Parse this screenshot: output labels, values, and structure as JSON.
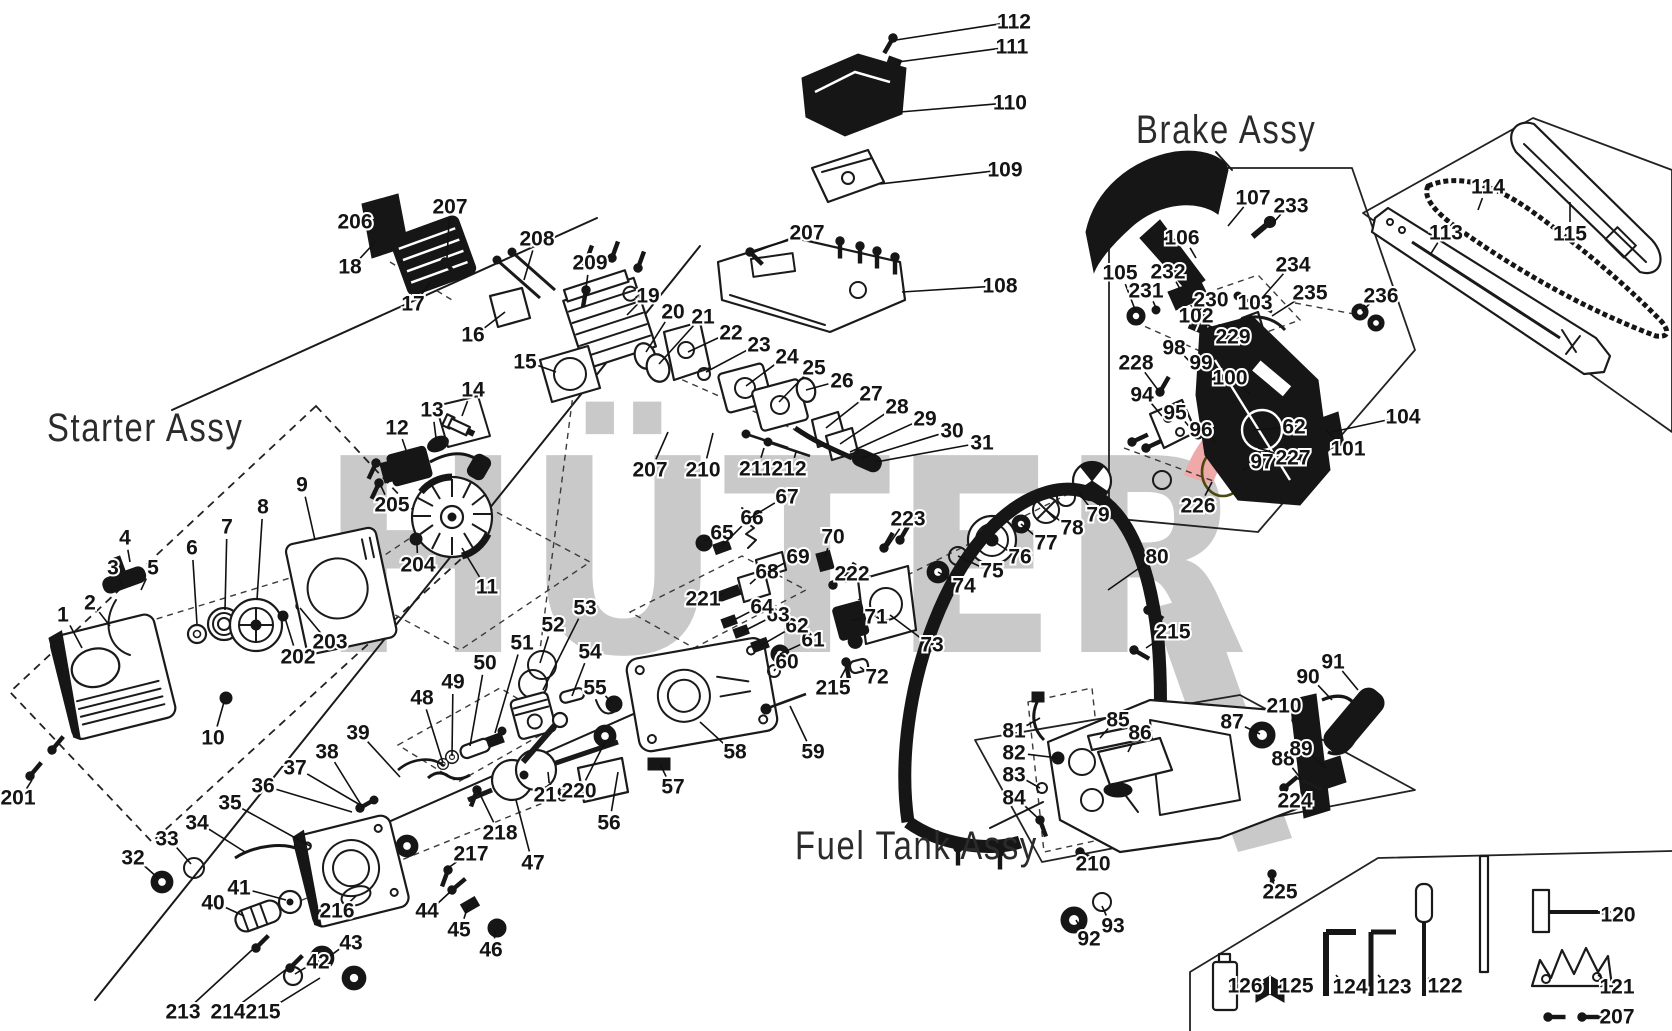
{
  "watermark": {
    "text": "HÜTER",
    "gray": "#c9c9c9",
    "pink": "#efa9a9",
    "dark_red": "#7d1416",
    "yellow": "#f7f3a6"
  },
  "assemblies": [
    {
      "label": "Starter Assy",
      "x": 47,
      "y": 406
    },
    {
      "label": "Brake Assy",
      "x": 1136,
      "y": 108
    },
    {
      "label": "Fuel Tank Assy",
      "x": 795,
      "y": 824
    }
  ],
  "parts": [
    {
      "n": "1",
      "x": 63,
      "y": 615,
      "t": [
        82,
        648
      ]
    },
    {
      "n": "2",
      "x": 90,
      "y": 603,
      "t": [
        110,
        626
      ]
    },
    {
      "n": "3",
      "x": 113,
      "y": 568,
      "t": [
        122,
        586
      ]
    },
    {
      "n": "4",
      "x": 125,
      "y": 538,
      "t": [
        130,
        562
      ]
    },
    {
      "n": "5",
      "x": 153,
      "y": 568,
      "t": [
        141,
        590
      ]
    },
    {
      "n": "6",
      "x": 192,
      "y": 548,
      "t": [
        197,
        624
      ]
    },
    {
      "n": "7",
      "x": 227,
      "y": 527,
      "t": [
        225,
        610
      ]
    },
    {
      "n": "8",
      "x": 263,
      "y": 507,
      "t": [
        257,
        600
      ]
    },
    {
      "n": "9",
      "x": 302,
      "y": 485,
      "t": [
        315,
        540
      ]
    },
    {
      "n": "10",
      "x": 213,
      "y": 738,
      "t": [
        224,
        702
      ]
    },
    {
      "n": "11",
      "x": 487,
      "y": 587,
      "t": [
        462,
        548
      ]
    },
    {
      "n": "12",
      "x": 397,
      "y": 428,
      "t": [
        406,
        450
      ]
    },
    {
      "n": "13",
      "x": 432,
      "y": 410,
      "t": [
        436,
        438
      ]
    },
    {
      "n": "14",
      "x": 473,
      "y": 390,
      "t": [
        462,
        416
      ]
    },
    {
      "n": "15",
      "x": 525,
      "y": 362,
      "t": [
        556,
        372
      ]
    },
    {
      "n": "16",
      "x": 473,
      "y": 335,
      "t": [
        505,
        312
      ]
    },
    {
      "n": "17",
      "x": 413,
      "y": 304,
      "t": [
        430,
        282
      ]
    },
    {
      "n": "18",
      "x": 350,
      "y": 267,
      "t": [
        377,
        240
      ]
    },
    {
      "n": "19",
      "x": 648,
      "y": 296,
      "t": [
        627,
        315
      ]
    },
    {
      "n": "20",
      "x": 673,
      "y": 312,
      "t": [
        646,
        352
      ]
    },
    {
      "n": "21",
      "x": 703,
      "y": 317,
      "t": [
        659,
        364
      ]
    },
    {
      "n": "22",
      "x": 731,
      "y": 333,
      "t": [
        688,
        352
      ]
    },
    {
      "n": "23",
      "x": 759,
      "y": 345,
      "t": [
        706,
        372
      ]
    },
    {
      "n": "24",
      "x": 787,
      "y": 357,
      "t": [
        746,
        386
      ]
    },
    {
      "n": "25",
      "x": 814,
      "y": 368,
      "t": [
        779,
        402
      ]
    },
    {
      "n": "26",
      "x": 842,
      "y": 381,
      "t": [
        806,
        390
      ]
    },
    {
      "n": "27",
      "x": 871,
      "y": 394,
      "t": [
        826,
        428
      ]
    },
    {
      "n": "28",
      "x": 897,
      "y": 407,
      "t": [
        840,
        444
      ]
    },
    {
      "n": "29",
      "x": 925,
      "y": 419,
      "t": [
        850,
        452
      ]
    },
    {
      "n": "30",
      "x": 952,
      "y": 431,
      "t": [
        862,
        458
      ]
    },
    {
      "n": "31",
      "x": 982,
      "y": 443,
      "t": [
        876,
        462
      ]
    },
    {
      "n": "32",
      "x": 133,
      "y": 858,
      "t": [
        158,
        878
      ]
    },
    {
      "n": "33",
      "x": 167,
      "y": 839,
      "t": [
        191,
        864
      ]
    },
    {
      "n": "34",
      "x": 197,
      "y": 823,
      "t": [
        245,
        852
      ]
    },
    {
      "n": "35",
      "x": 230,
      "y": 803,
      "t": [
        310,
        846
      ]
    },
    {
      "n": "36",
      "x": 263,
      "y": 786,
      "t": [
        352,
        812
      ]
    },
    {
      "n": "37",
      "x": 295,
      "y": 768,
      "t": [
        362,
        806
      ]
    },
    {
      "n": "38",
      "x": 327,
      "y": 752,
      "t": [
        363,
        808
      ]
    },
    {
      "n": "39",
      "x": 358,
      "y": 733,
      "t": [
        400,
        777
      ]
    },
    {
      "n": "40",
      "x": 213,
      "y": 903,
      "t": [
        244,
        916
      ]
    },
    {
      "n": "41",
      "x": 239,
      "y": 888,
      "t": [
        286,
        900
      ]
    },
    {
      "n": "42",
      "x": 318,
      "y": 962,
      "t": [
        295,
        974
      ]
    },
    {
      "n": "43",
      "x": 351,
      "y": 943,
      "t": [
        330,
        956
      ]
    },
    {
      "n": "44",
      "x": 427,
      "y": 911,
      "t": [
        450,
        892
      ]
    },
    {
      "n": "45",
      "x": 459,
      "y": 930,
      "t": [
        468,
        906
      ]
    },
    {
      "n": "46",
      "x": 491,
      "y": 950,
      "t": [
        496,
        930
      ]
    },
    {
      "n": "47",
      "x": 533,
      "y": 863,
      "t": [
        516,
        800
      ]
    },
    {
      "n": "48",
      "x": 422,
      "y": 698,
      "t": [
        443,
        763
      ]
    },
    {
      "n": "49",
      "x": 453,
      "y": 682,
      "t": [
        452,
        756
      ]
    },
    {
      "n": "50",
      "x": 485,
      "y": 663,
      "t": [
        470,
        746
      ]
    },
    {
      "n": "51",
      "x": 522,
      "y": 643,
      "t": [
        495,
        733
      ]
    },
    {
      "n": "52",
      "x": 553,
      "y": 625,
      "t": [
        540,
        663
      ]
    },
    {
      "n": "53",
      "x": 585,
      "y": 608,
      "t": [
        543,
        690
      ]
    },
    {
      "n": "54",
      "x": 590,
      "y": 652,
      "t": [
        572,
        696
      ]
    },
    {
      "n": "55",
      "x": 595,
      "y": 688,
      "t": [
        612,
        703
      ]
    },
    {
      "n": "56",
      "x": 609,
      "y": 823,
      "t": [
        618,
        772
      ]
    },
    {
      "n": "57",
      "x": 673,
      "y": 787,
      "t": [
        660,
        764
      ]
    },
    {
      "n": "58",
      "x": 735,
      "y": 752,
      "t": [
        700,
        722
      ]
    },
    {
      "n": "59",
      "x": 813,
      "y": 752,
      "t": [
        790,
        706
      ]
    },
    {
      "n": "60",
      "x": 787,
      "y": 662,
      "t": [
        774,
        671
      ]
    },
    {
      "n": "61",
      "x": 813,
      "y": 640,
      "t": [
        780,
        654
      ]
    },
    {
      "n": "62",
      "x": 797,
      "y": 626,
      "t": [
        760,
        646
      ]
    },
    {
      "n": "62",
      "x": 1294,
      "y": 427,
      "t": [
        1253,
        430
      ]
    },
    {
      "n": "63",
      "x": 778,
      "y": 615,
      "t": [
        742,
        632
      ]
    },
    {
      "n": "64",
      "x": 762,
      "y": 607,
      "t": [
        730,
        622
      ]
    },
    {
      "n": "65",
      "x": 722,
      "y": 533,
      "t": [
        704,
        541
      ]
    },
    {
      "n": "66",
      "x": 752,
      "y": 518,
      "t": [
        722,
        546
      ]
    },
    {
      "n": "67",
      "x": 787,
      "y": 497,
      "t": [
        750,
        518
      ]
    },
    {
      "n": "68",
      "x": 767,
      "y": 572,
      "t": [
        750,
        584
      ]
    },
    {
      "n": "69",
      "x": 798,
      "y": 557,
      "t": [
        768,
        572
      ]
    },
    {
      "n": "70",
      "x": 833,
      "y": 537,
      "t": [
        825,
        557
      ]
    },
    {
      "n": "71",
      "x": 876,
      "y": 617,
      "t": [
        852,
        620
      ]
    },
    {
      "n": "72",
      "x": 877,
      "y": 677,
      "t": [
        860,
        667
      ]
    },
    {
      "n": "73",
      "x": 932,
      "y": 645,
      "t": [
        890,
        615
      ]
    },
    {
      "n": "74",
      "x": 964,
      "y": 586,
      "t": [
        938,
        572
      ]
    },
    {
      "n": "75",
      "x": 992,
      "y": 571,
      "t": [
        958,
        556
      ]
    },
    {
      "n": "76",
      "x": 1020,
      "y": 557,
      "t": [
        992,
        540
      ]
    },
    {
      "n": "77",
      "x": 1046,
      "y": 543,
      "t": [
        1021,
        524
      ]
    },
    {
      "n": "78",
      "x": 1072,
      "y": 528,
      "t": [
        1046,
        510
      ]
    },
    {
      "n": "79",
      "x": 1098,
      "y": 515,
      "t": [
        1078,
        492
      ]
    },
    {
      "n": "80",
      "x": 1157,
      "y": 557,
      "t": [
        1108,
        590
      ]
    },
    {
      "n": "81",
      "x": 1014,
      "y": 731,
      "t": [
        1040,
        718
      ]
    },
    {
      "n": "82",
      "x": 1014,
      "y": 753,
      "t": [
        1058,
        758
      ]
    },
    {
      "n": "83",
      "x": 1014,
      "y": 775,
      "t": [
        1040,
        788
      ]
    },
    {
      "n": "84",
      "x": 1014,
      "y": 798,
      "t": [
        1040,
        820
      ]
    },
    {
      "n": "85",
      "x": 1118,
      "y": 720,
      "t": [
        1100,
        738
      ]
    },
    {
      "n": "86",
      "x": 1140,
      "y": 733,
      "t": [
        1128,
        752
      ]
    },
    {
      "n": "87",
      "x": 1232,
      "y": 722,
      "t": [
        1260,
        734
      ]
    },
    {
      "n": "88",
      "x": 1283,
      "y": 759,
      "t": [
        1302,
        780
      ]
    },
    {
      "n": "89",
      "x": 1301,
      "y": 749,
      "t": [
        1326,
        768
      ]
    },
    {
      "n": "90",
      "x": 1308,
      "y": 677,
      "t": [
        1332,
        700
      ]
    },
    {
      "n": "91",
      "x": 1333,
      "y": 662,
      "t": [
        1358,
        690
      ]
    },
    {
      "n": "92",
      "x": 1089,
      "y": 939,
      "t": [
        1076,
        920
      ]
    },
    {
      "n": "93",
      "x": 1113,
      "y": 926,
      "t": [
        1102,
        906
      ]
    },
    {
      "n": "94",
      "x": 1142,
      "y": 395,
      "t": [
        1162,
        416
      ]
    },
    {
      "n": "95",
      "x": 1175,
      "y": 413,
      "t": [
        1192,
        430
      ]
    },
    {
      "n": "96",
      "x": 1201,
      "y": 430,
      "t": [
        1216,
        443
      ]
    },
    {
      "n": "97",
      "x": 1262,
      "y": 462,
      "t": [
        1242,
        470
      ]
    },
    {
      "n": "98",
      "x": 1174,
      "y": 348,
      "t": [
        1194,
        366
      ]
    },
    {
      "n": "99",
      "x": 1201,
      "y": 363,
      "t": [
        1217,
        378
      ]
    },
    {
      "n": "100",
      "x": 1230,
      "y": 378,
      "t": [
        1250,
        394
      ]
    },
    {
      "n": "101",
      "x": 1348,
      "y": 449,
      "t": [
        1326,
        430
      ]
    },
    {
      "n": "102",
      "x": 1196,
      "y": 316,
      "t": [
        1212,
        329
      ]
    },
    {
      "n": "103",
      "x": 1255,
      "y": 303,
      "t": [
        1250,
        318
      ]
    },
    {
      "n": "104",
      "x": 1403,
      "y": 417,
      "t": [
        1332,
        432
      ]
    },
    {
      "n": "105",
      "x": 1120,
      "y": 273,
      "t": [
        1136,
        312
      ]
    },
    {
      "n": "106",
      "x": 1182,
      "y": 238,
      "t": [
        1196,
        258
      ]
    },
    {
      "n": "107",
      "x": 1253,
      "y": 198,
      "t": [
        1228,
        226
      ]
    },
    {
      "n": "108",
      "x": 1000,
      "y": 286,
      "t": [
        902,
        292
      ]
    },
    {
      "n": "109",
      "x": 1005,
      "y": 170,
      "t": [
        880,
        184
      ]
    },
    {
      "n": "110",
      "x": 1010,
      "y": 103,
      "t": [
        900,
        112
      ]
    },
    {
      "n": "111",
      "x": 1012,
      "y": 47,
      "t": [
        898,
        62
      ]
    },
    {
      "n": "112",
      "x": 1014,
      "y": 22,
      "t": [
        896,
        40
      ]
    },
    {
      "n": "113",
      "x": 1446,
      "y": 233,
      "t": [
        1430,
        255
      ]
    },
    {
      "n": "114",
      "x": 1488,
      "y": 187,
      "t": [
        1478,
        210
      ]
    },
    {
      "n": "115",
      "x": 1570,
      "y": 234,
      "t": [
        1570,
        202
      ]
    },
    {
      "n": "120",
      "x": 1618,
      "y": 915,
      "t": [
        1598,
        913
      ]
    },
    {
      "n": "121",
      "x": 1617,
      "y": 987,
      "t": [
        1598,
        975
      ]
    },
    {
      "n": "122",
      "x": 1445,
      "y": 986,
      "t": [
        1428,
        978
      ]
    },
    {
      "n": "123",
      "x": 1394,
      "y": 987,
      "t": [
        1378,
        975
      ]
    },
    {
      "n": "124",
      "x": 1350,
      "y": 987,
      "t": [
        1336,
        975
      ]
    },
    {
      "n": "125",
      "x": 1296,
      "y": 986,
      "t": [
        1284,
        988
      ]
    },
    {
      "n": "126",
      "x": 1245,
      "y": 986,
      "t": [
        1230,
        986
      ]
    },
    {
      "n": "201",
      "x": 18,
      "y": 798,
      "t": [
        32,
        780
      ]
    },
    {
      "n": "202",
      "x": 298,
      "y": 657,
      "t": [
        285,
        618
      ]
    },
    {
      "n": "203",
      "x": 330,
      "y": 642,
      "t": [
        300,
        608
      ]
    },
    {
      "n": "204",
      "x": 418,
      "y": 565,
      "t": [
        417,
        544
      ]
    },
    {
      "n": "205",
      "x": 392,
      "y": 505,
      "t": [
        381,
        486
      ]
    },
    {
      "n": "206",
      "x": 355,
      "y": 222,
      "t": [
        371,
        228
      ]
    },
    {
      "n": "207",
      "x": 450,
      "y": 207,
      "t": [
        447,
        258
      ]
    },
    {
      "n": "207",
      "x": 807,
      "y": 233,
      "t": [
        752,
        253
      ]
    },
    {
      "n": "207",
      "x": 650,
      "y": 470,
      "t": [
        668,
        432
      ]
    },
    {
      "n": "207",
      "x": 1617,
      "y": 1017,
      "t": [
        1597,
        1017
      ]
    },
    {
      "n": "208",
      "x": 537,
      "y": 239,
      "t": [
        524,
        280
      ]
    },
    {
      "n": "209",
      "x": 590,
      "y": 263,
      "t": [
        586,
        288
      ]
    },
    {
      "n": "210",
      "x": 703,
      "y": 470,
      "t": [
        713,
        433
      ]
    },
    {
      "n": "210",
      "x": 1284,
      "y": 706,
      "t": [
        1294,
        719
      ]
    },
    {
      "n": "210",
      "x": 1093,
      "y": 864,
      "t": [
        1081,
        853
      ]
    },
    {
      "n": "211",
      "x": 756,
      "y": 469,
      "t": [
        764,
        448
      ]
    },
    {
      "n": "212",
      "x": 789,
      "y": 469,
      "t": [
        796,
        452
      ]
    },
    {
      "n": "213",
      "x": 183,
      "y": 1012,
      "t": [
        252,
        950
      ]
    },
    {
      "n": "214",
      "x": 228,
      "y": 1012,
      "t": [
        288,
        968
      ]
    },
    {
      "n": "215",
      "x": 263,
      "y": 1012,
      "t": [
        320,
        978
      ]
    },
    {
      "n": "215",
      "x": 833,
      "y": 688,
      "t": [
        846,
        668
      ]
    },
    {
      "n": "215",
      "x": 1173,
      "y": 632,
      "t": [
        1146,
        648
      ]
    },
    {
      "n": "216",
      "x": 337,
      "y": 911,
      "t": [
        356,
        896
      ]
    },
    {
      "n": "217",
      "x": 471,
      "y": 854,
      "t": [
        448,
        868
      ]
    },
    {
      "n": "218",
      "x": 500,
      "y": 833,
      "t": [
        477,
        788
      ]
    },
    {
      "n": "219",
      "x": 551,
      "y": 795,
      "t": [
        548,
        772
      ]
    },
    {
      "n": "220",
      "x": 579,
      "y": 791,
      "t": [
        605,
        742
      ]
    },
    {
      "n": "221",
      "x": 703,
      "y": 599,
      "t": [
        724,
        594
      ]
    },
    {
      "n": "222",
      "x": 852,
      "y": 574,
      "t": [
        838,
        582
      ]
    },
    {
      "n": "223",
      "x": 908,
      "y": 519,
      "t": [
        888,
        546
      ]
    },
    {
      "n": "224",
      "x": 1295,
      "y": 801,
      "t": [
        1286,
        788
      ]
    },
    {
      "n": "225",
      "x": 1280,
      "y": 892,
      "t": [
        1272,
        874
      ]
    },
    {
      "n": "226",
      "x": 1198,
      "y": 506,
      "t": [
        1212,
        482
      ]
    },
    {
      "n": "227",
      "x": 1293,
      "y": 458,
      "t": [
        1258,
        448
      ]
    },
    {
      "n": "228",
      "x": 1136,
      "y": 363,
      "t": [
        1158,
        390
      ]
    },
    {
      "n": "229",
      "x": 1233,
      "y": 337,
      "t": [
        1222,
        330
      ]
    },
    {
      "n": "230",
      "x": 1211,
      "y": 300,
      "t": [
        1200,
        310
      ]
    },
    {
      "n": "231",
      "x": 1146,
      "y": 291,
      "t": [
        1156,
        308
      ]
    },
    {
      "n": "232",
      "x": 1168,
      "y": 272,
      "t": [
        1180,
        289
      ]
    },
    {
      "n": "233",
      "x": 1291,
      "y": 206,
      "t": [
        1274,
        222
      ]
    },
    {
      "n": "234",
      "x": 1293,
      "y": 265,
      "t": [
        1262,
        298
      ]
    },
    {
      "n": "235",
      "x": 1310,
      "y": 293,
      "t": [
        1272,
        316
      ]
    },
    {
      "n": "236",
      "x": 1381,
      "y": 296,
      "t": [
        1362,
        311
      ]
    }
  ]
}
